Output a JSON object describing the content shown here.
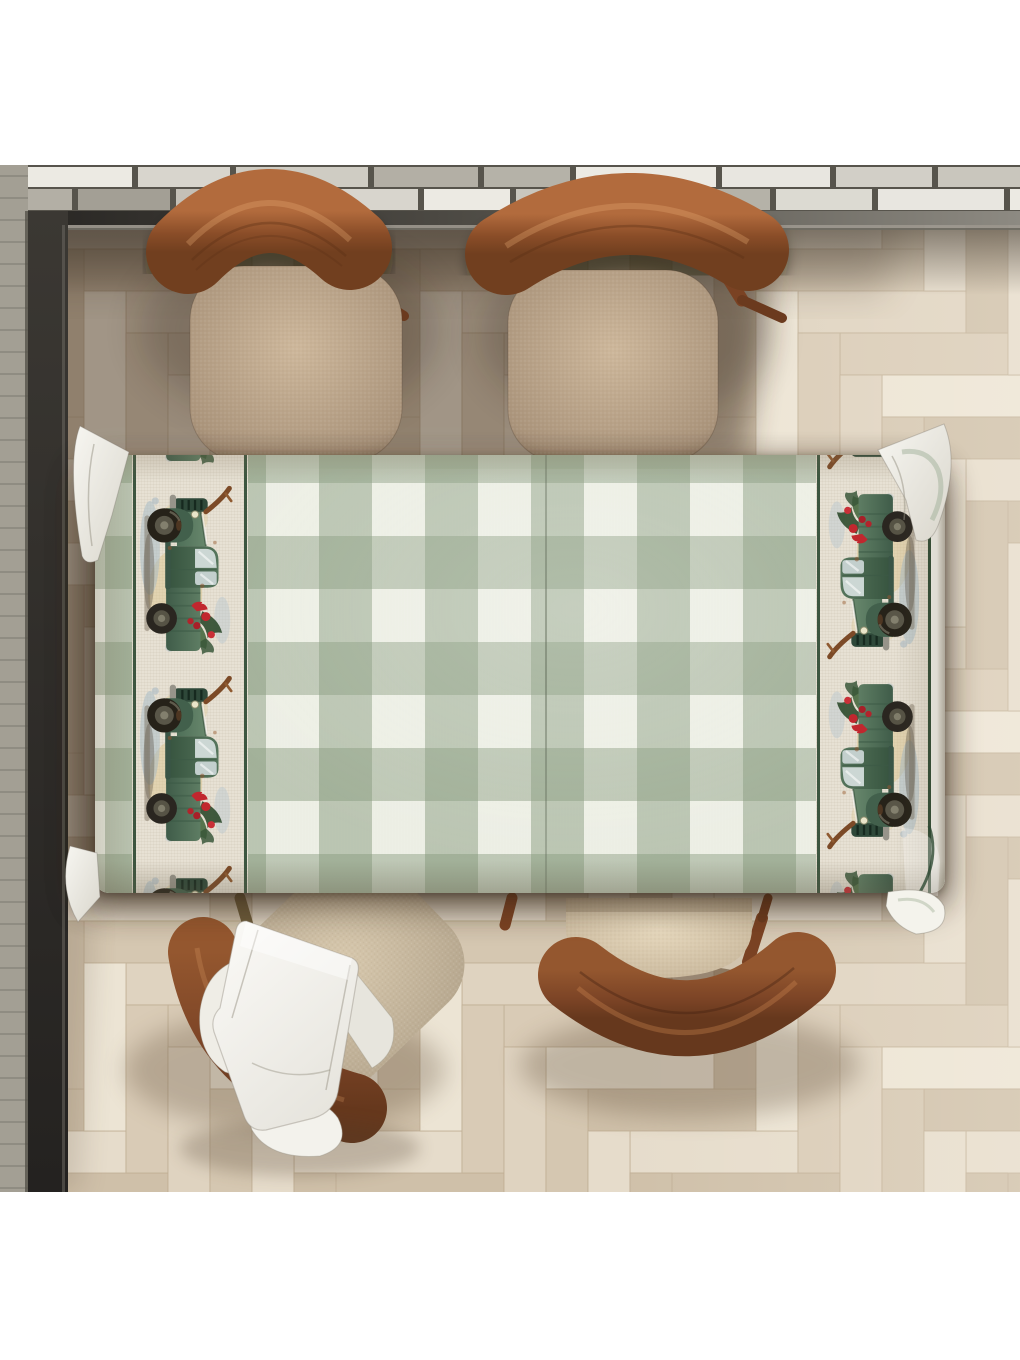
{
  "labels": {
    "stage": "Top-down render of dining table with gingham truck tablecloth",
    "scene": "Dining room scene viewed from above",
    "wall": "Gray brick wall with dark baseboard trim",
    "floor": "Light herringbone parquet wood floor",
    "tablecloth": "Green buffalo-check tablecloth with vintage green truck border strips",
    "truck": "Watercolor vintage green pickup truck with Christmas greenery and red poinsettia bow",
    "chair_top_left": "Wooden chair with beige cushion, top left",
    "chair_top_right": "Wooden chair with beige cushion, top right",
    "chair_bottom_left": "Wooden chair bottom left with draped white cloth",
    "chair_bottom_right": "Wooden chair bottom right",
    "napkin": "White folded cloth draped over bottom-left chair",
    "corner_flap": "Draped tablecloth corner fold"
  },
  "counts": {
    "chairs": 4,
    "truck_motifs_per_border": 4,
    "border_strips": 2
  },
  "palette": {
    "cloth_base": "#f2f3eb",
    "gingham_a": "rgba(134,153,124,0.50)",
    "gingham_b": "rgba(128,148,119,0.46)",
    "gingham_faint": "rgba(190,200,180,0.06)",
    "linen": "#e7e1d4",
    "piping": "#2e4a33",
    "truck_green_light": "#68876c",
    "truck_green_dark": "#3f5c49",
    "poinsettia_red": "#c1272e",
    "wood_light": "#b26b3d",
    "wood_mid": "#8a4d28",
    "wood_dark": "#66381d",
    "cushion_light": "#cdb79b",
    "cushion_shade": "#94806a",
    "cushion_pale": "#e6d8bd",
    "napkin_white": "#fbfaf7",
    "mortar": "#57544c",
    "trim_dark": "#282623",
    "trim_light": "#8d8a82",
    "shadow_brown": "#3a2a1c"
  },
  "wall": {
    "brick_palette_left": [
      "#c4c0b7",
      "#b3afa5",
      "#d8d5cd",
      "#a39f95",
      "#cfccc3"
    ],
    "brick_palette_right": [
      "#dcdad2",
      "#c9c6bd",
      "#e8e6e0",
      "#b5b2a8",
      "#d2cfc7"
    ],
    "accent_brick": "#eceae3",
    "mortar": "#57544c",
    "left_strip": "#a39f94"
  },
  "floor": {
    "palette": [
      "#dfd3c0",
      "#d5c7b1",
      "#e6dccb",
      "#cfc0a9",
      "#ece4d4",
      "#d9cbb6"
    ],
    "gap_color": "#bfae94",
    "plank_width": 42,
    "plank_length": 168
  },
  "tablecloth": {
    "check_px": 53,
    "truck_tile_height": 190,
    "left_strip_tiles": [
      -162,
      28,
      218,
      408
    ],
    "right_strip_tiles": [
      -168,
      22,
      212,
      402
    ]
  }
}
